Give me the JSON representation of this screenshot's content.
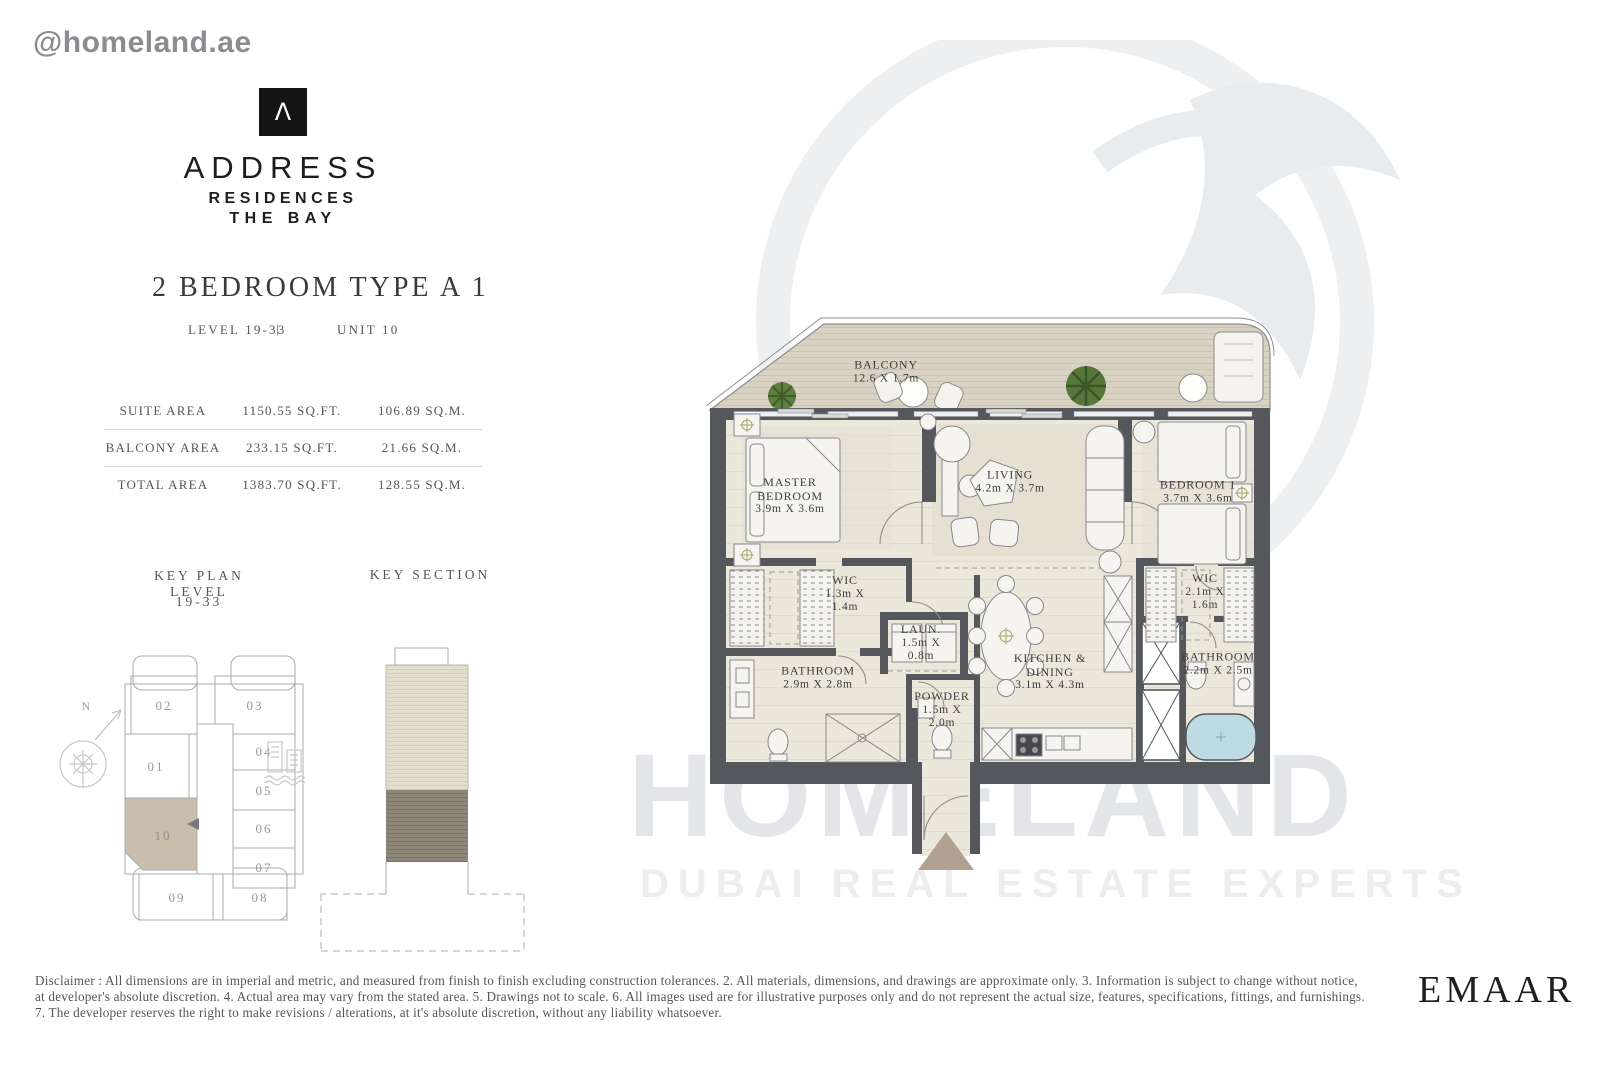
{
  "watermark_handle": "@homeland.ae",
  "brand": {
    "logo_symbol": "Λ",
    "name": "ADDRESS",
    "sub1": "RESIDENCES",
    "sub2": "THE BAY"
  },
  "unit": {
    "title": "2 BEDROOM TYPE A 1",
    "level_label": "LEVEL 19-33",
    "separator": "|",
    "unit_label": "UNIT 10"
  },
  "areas": {
    "rows": [
      {
        "label": "SUITE AREA",
        "sqft": "1150.55 SQ.FT.",
        "sqm": "106.89 SQ.M."
      },
      {
        "label": "BALCONY AREA",
        "sqft": "233.15 SQ.FT.",
        "sqm": "21.66 SQ.M."
      },
      {
        "label": "TOTAL AREA",
        "sqft": "1383.70 SQ.FT.",
        "sqm": "128.55 SQ.M."
      }
    ]
  },
  "key_plan": {
    "title": "KEY PLAN LEVEL",
    "subtitle": "19-33",
    "north_label": "N",
    "units": [
      "01",
      "02",
      "03",
      "04",
      "05",
      "06",
      "07",
      "08",
      "09",
      "10"
    ],
    "highlighted_unit": "10",
    "highlight_color": "#c9beac"
  },
  "key_section": {
    "title": "KEY SECTION"
  },
  "floor_plan": {
    "rooms": [
      {
        "name": "BALCONY",
        "dims": "12.6 X 1.7m"
      },
      {
        "name": "MASTER BEDROOM",
        "dims": "3.9m X 3.6m"
      },
      {
        "name": "LIVING",
        "dims": "4.2m X 3.7m"
      },
      {
        "name": "BEDROOM 1",
        "dims": "3.7m X 3.6m"
      },
      {
        "name": "WIC",
        "dims": "1.3m X 1.4m"
      },
      {
        "name": "LAUN.",
        "dims": "1.5m X 0.8m"
      },
      {
        "name": "BATHROOM",
        "dims": "2.9m X 2.8m"
      },
      {
        "name": "POWDER",
        "dims": "1.5m X 2.0m"
      },
      {
        "name": "KITCHEN & DINING",
        "dims": "3.1m X 4.3m"
      },
      {
        "name": "WIC",
        "dims": "2.1m X 1.6m"
      },
      {
        "name": "BATHROOM",
        "dims": "2.2m X 2.5m"
      }
    ]
  },
  "watermark": {
    "line1": "HOMELAND",
    "line2": "DUBAI REAL ESTATE EXPERTS"
  },
  "developer_logo": "EMAAR",
  "disclaimer": {
    "lines": [
      "Disclaimer : All dimensions are in imperial and metric, and measured from finish to finish excluding construction tolerances. 2. All materials, dimensions, and drawings are approximate only. 3. Information is subject to change without notice,",
      "at developer's absolute discretion. 4. Actual area may vary from the stated area. 5. Drawings not to scale. 6. All images used are for illustrative purposes only and do not represent the actual size, features, specifications, fittings, and furnishings.",
      "7. The developer reserves the right to make revisions / alterations, at it's absolute discretion, without any liability whatsoever."
    ]
  },
  "colors": {
    "wall": "#54575b",
    "highlight": "#c9beac",
    "balcony_floor": "#d9d1c2",
    "tub_water": "#bedbe4",
    "watermark": "#e3e5e8"
  }
}
